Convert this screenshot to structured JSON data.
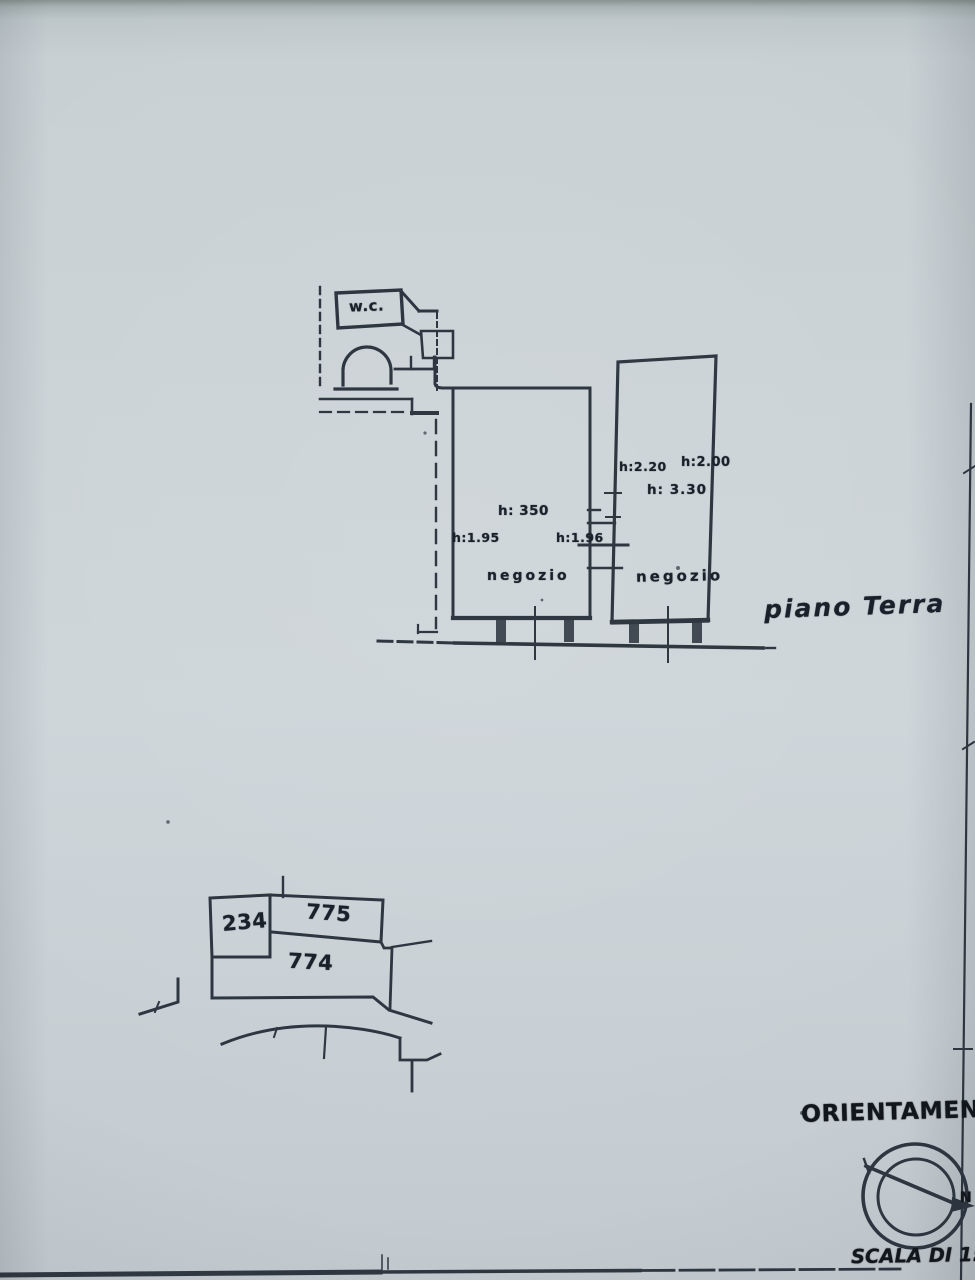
{
  "colors": {
    "paper": "#c8d0d4",
    "ink": "#232c36",
    "ink_dark": "#11161c"
  },
  "floor_plan": {
    "caption": "piano Terra",
    "wc_label": "w.c.",
    "room_left": {
      "name": "negozio",
      "height_center": "h: 350",
      "height_left": "h:1.95",
      "height_passage": "h:1.96"
    },
    "room_right": {
      "name": "negozio",
      "height_top_left": "h:2.20",
      "height_top_right": "h:2.00",
      "height_center": "h: 3.30"
    }
  },
  "site_plan": {
    "parcels": [
      "234",
      "775",
      "774"
    ]
  },
  "footer": {
    "orientation_title": "ORIENTAMENTO",
    "north_label": "N",
    "scale_label": "SCALA DI 1: 2"
  }
}
